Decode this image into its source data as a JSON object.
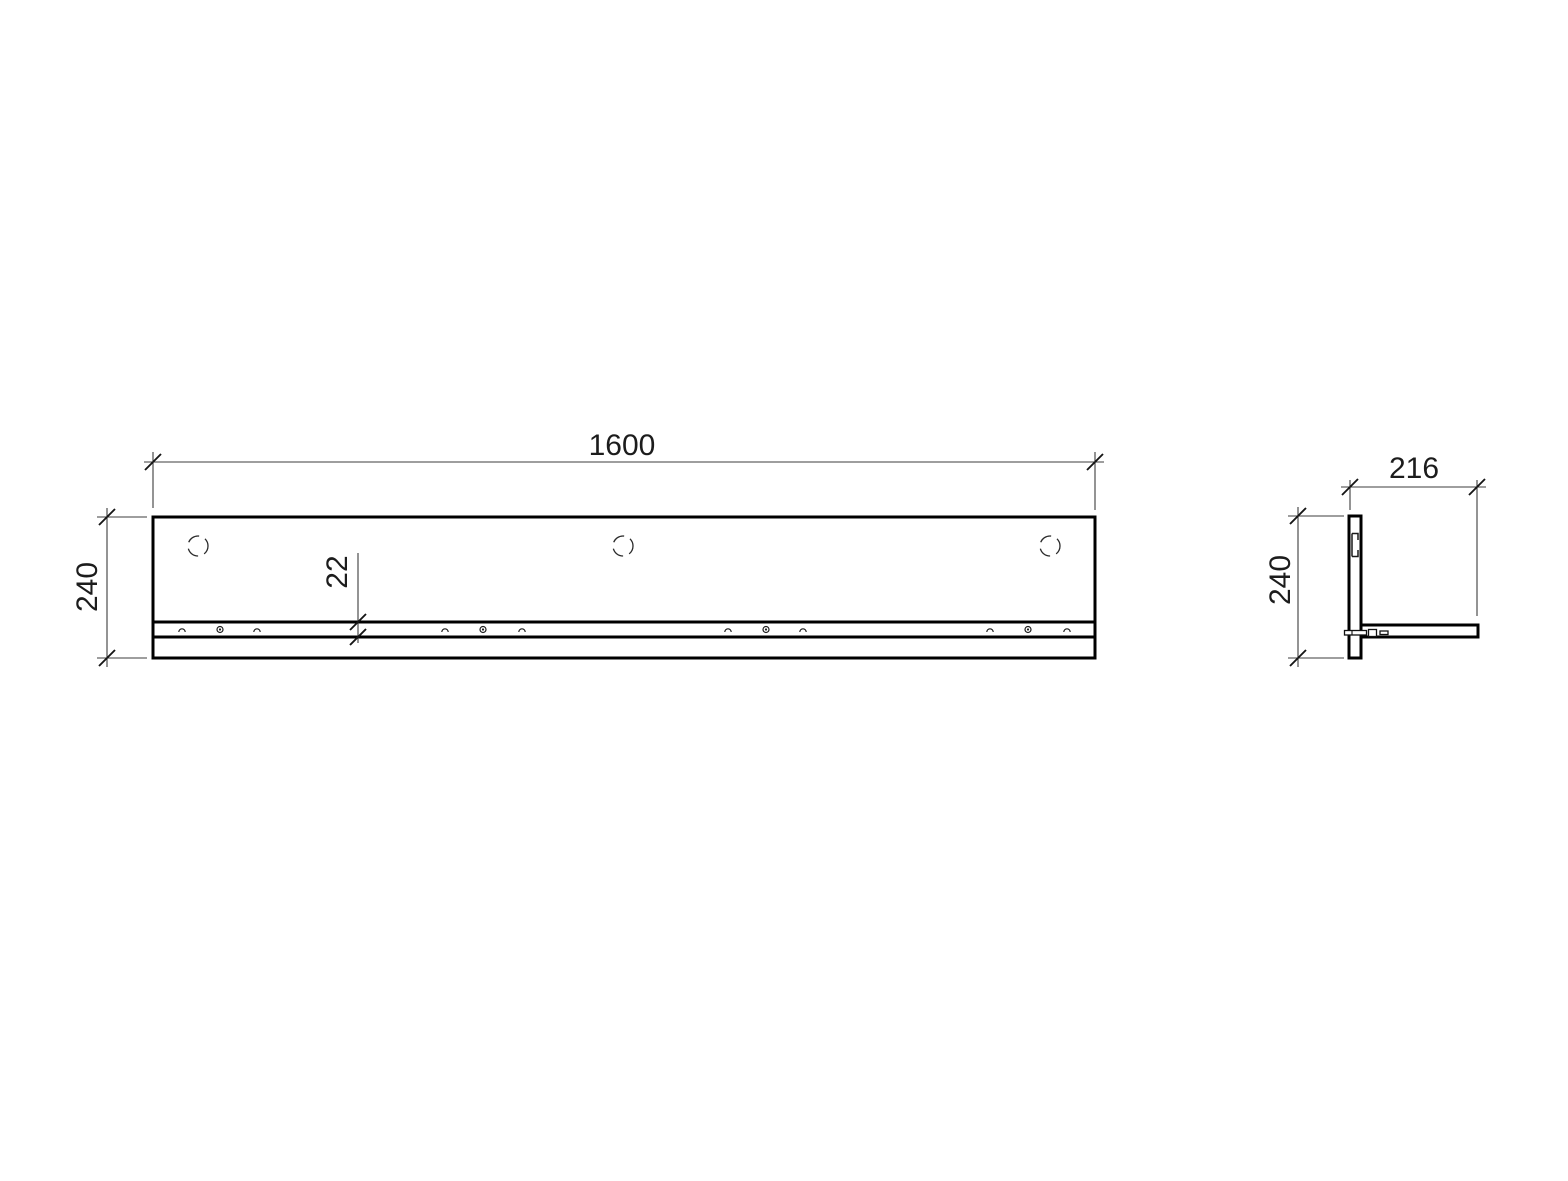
{
  "page": {
    "background_color": "#ffffff",
    "line_color": "#000000",
    "dimension_line_color": "#3c3c3c"
  },
  "front_view": {
    "width_dim": "1600",
    "height_dim": "240",
    "rail_offset_dim": "22"
  },
  "side_view": {
    "depth_dim": "216",
    "height_dim": "240"
  }
}
